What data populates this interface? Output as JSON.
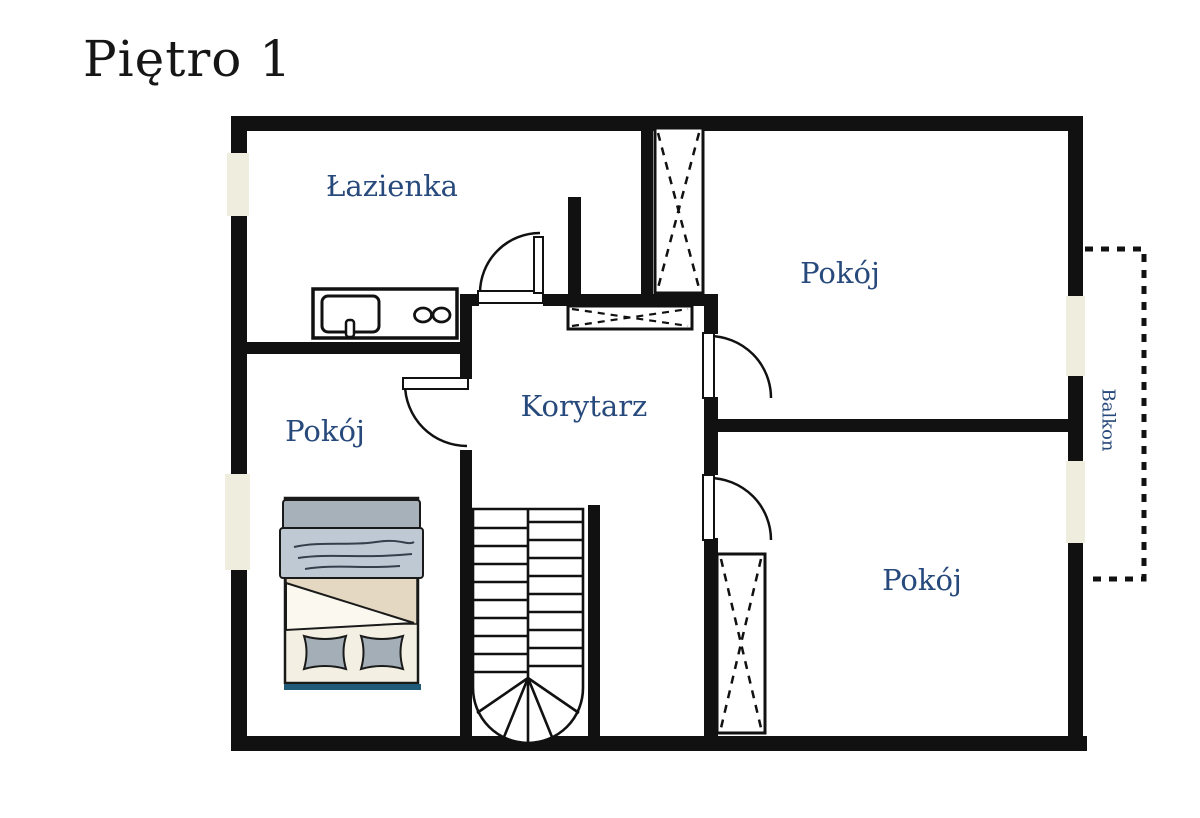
{
  "title": "Piętro 1",
  "rooms": {
    "bathroom": "Łazienka",
    "room_top_right": "Pokój",
    "corridor": "Korytarz",
    "room_left": "Pokój",
    "room_bottom_right": "Pokój",
    "balcony": "Balkon"
  },
  "colors": {
    "wall": "#111111",
    "label": "#27497b",
    "title": "#161616",
    "window_fill": "#efeede",
    "bed_frame": "#f3f0e3",
    "bed_blanket_top": "#a7b1b9",
    "bed_blanket": "#bfc9d4",
    "bed_sheet_beige": "#e4d8c2",
    "bed_duvet": "#faf8ef",
    "bed_pillow": "#a3aeb6",
    "bed_headboard_line": "#1f5a79"
  }
}
